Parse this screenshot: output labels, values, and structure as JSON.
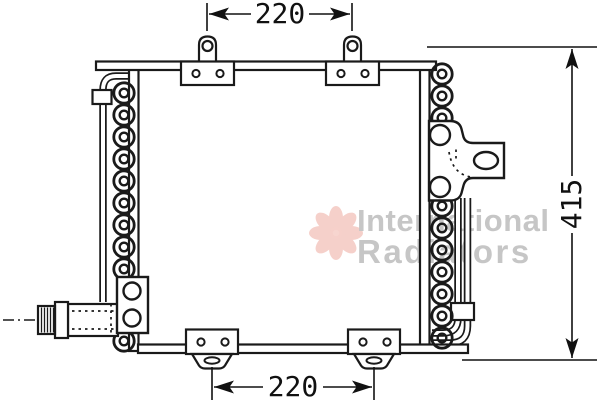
{
  "drawing": {
    "kind": "technical-line-drawing",
    "subject": "automotive condenser / radiator with mounting brackets, coiled side tubes and threaded inlet fitting"
  },
  "dimensions": {
    "top_width": {
      "label": "220"
    },
    "bottom_width": {
      "label": "220"
    },
    "right_height": {
      "label": "415"
    }
  },
  "watermark": {
    "line1": "International",
    "line2": "Radiators"
  },
  "colors": {
    "line": "#1a1a1a",
    "watermark_text": "#c6c6c6",
    "watermark_logo": "#eda296",
    "background": "#ffffff"
  }
}
